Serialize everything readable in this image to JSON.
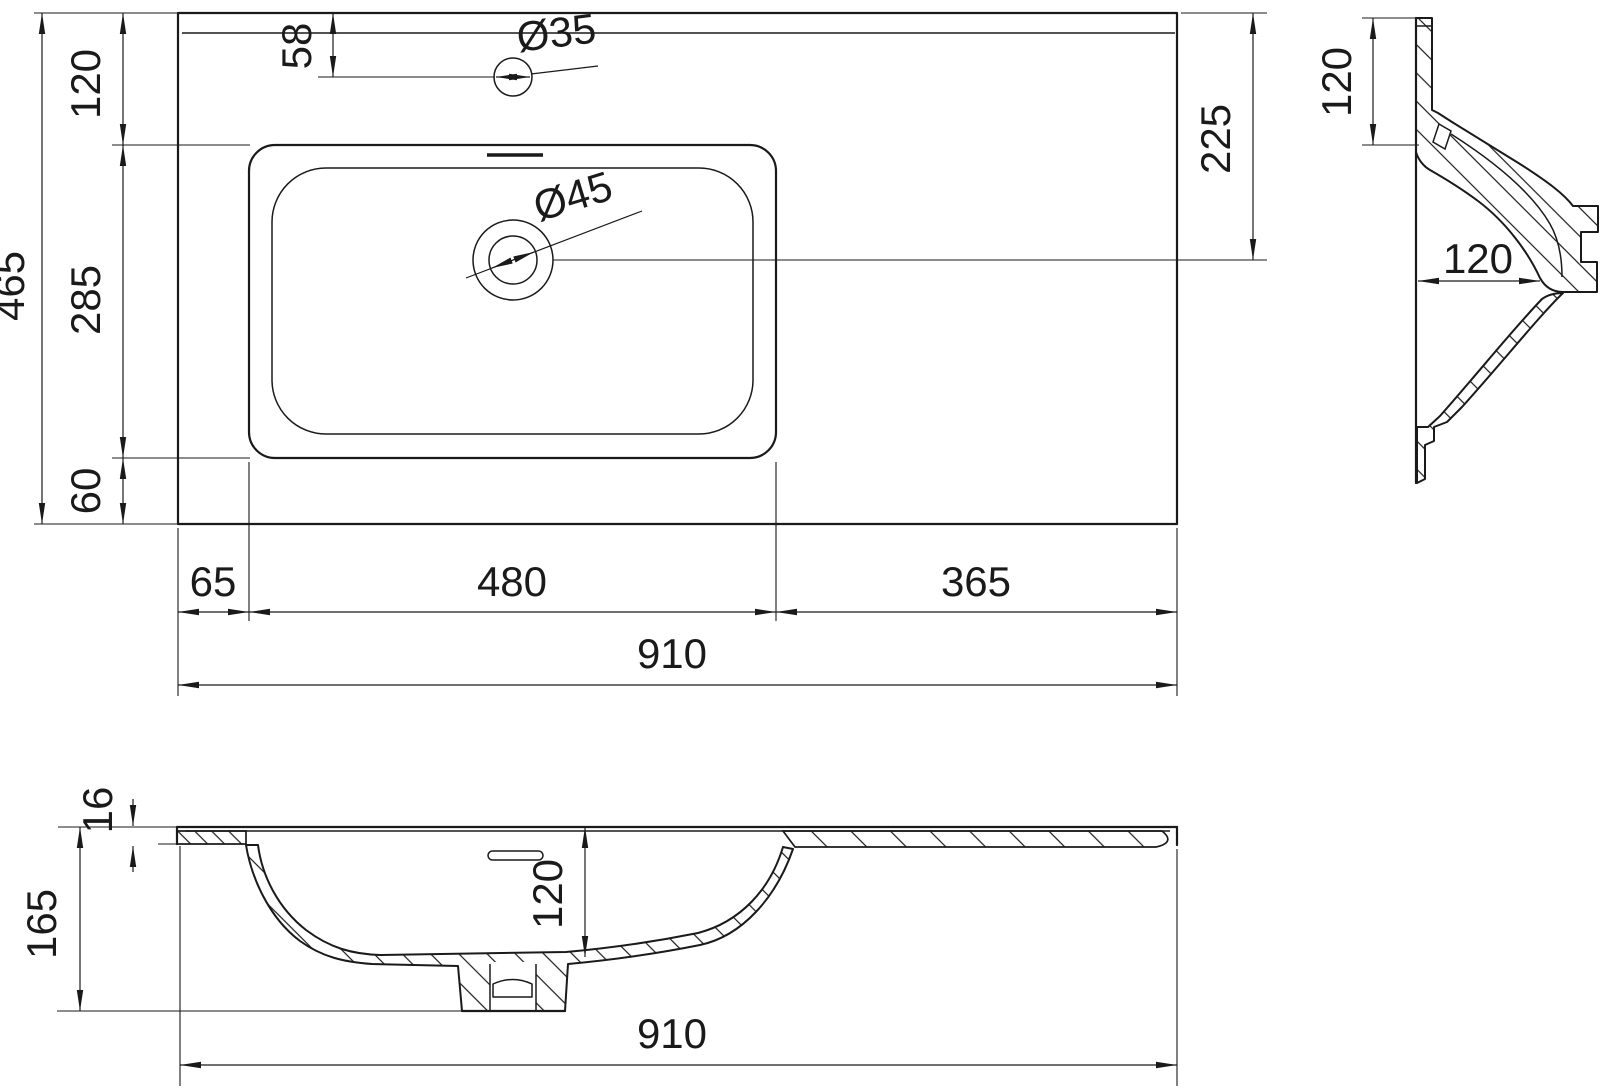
{
  "drawing_title": "washbasin-technical-drawing",
  "colors": {
    "background": "#ffffff",
    "line": "#1a1a1a"
  },
  "top_view": {
    "labels": {
      "total_depth": "465",
      "back_to_basin": "120",
      "basin_depth": "285",
      "basin_to_front": "60",
      "faucet_offset": "58",
      "faucet_hole_dia": "Ø35",
      "drain_hole_dia": "Ø45",
      "drain_offset": "225",
      "left_margin": "65",
      "basin_width": "480",
      "right_margin": "365",
      "total_width": "910"
    }
  },
  "side_view": {
    "labels": {
      "apron_height": "120",
      "basin_depth": "120"
    }
  },
  "front_view": {
    "labels": {
      "top_thickness": "16",
      "total_height": "165",
      "bowl_depth": "120",
      "total_width": "910"
    }
  }
}
